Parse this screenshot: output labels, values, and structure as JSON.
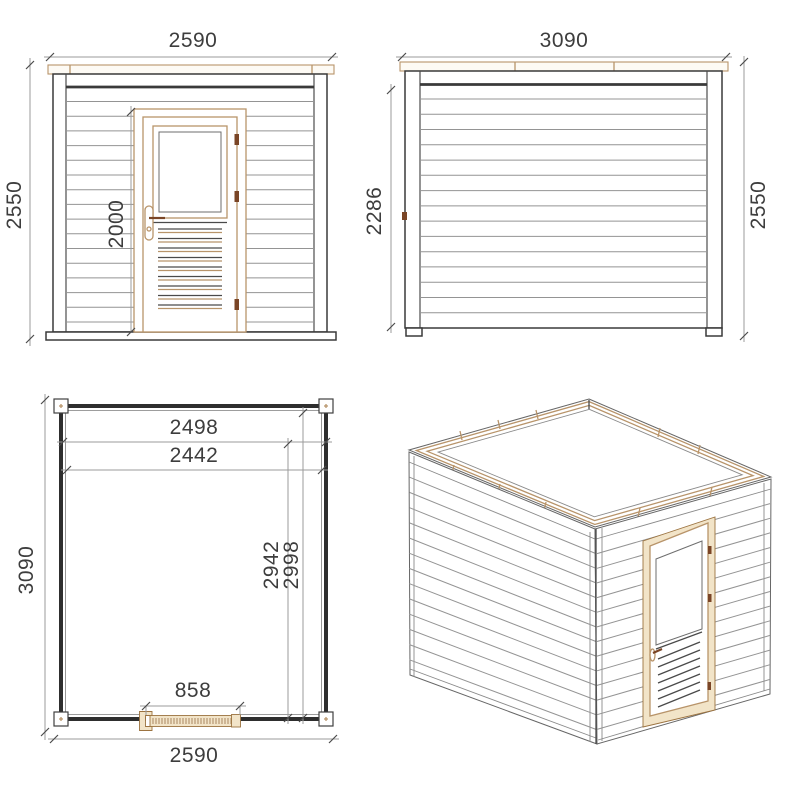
{
  "colors": {
    "background": "#ffffff",
    "outline_dark": "#3a3a3a",
    "siding_gray": "#949494",
    "dimension_line": "#9b9b9b",
    "dimension_text": "#3d3d3d",
    "wood_accent": "#b8946a",
    "wood_fill": "#f2e4c8",
    "hinge_brown": "#7a4526"
  },
  "views": {
    "front_elevation": {
      "dims": {
        "overall_width": "2590",
        "overall_height": "2550",
        "door_height": "2000"
      }
    },
    "side_elevation": {
      "dims": {
        "overall_width": "3090",
        "overall_height": "2550",
        "wall_height": "2286"
      }
    },
    "floor_plan": {
      "dims": {
        "inner_width": "2498",
        "inner_width_2": "2442",
        "overall_depth": "3090",
        "inner_depth": "2942",
        "inner_depth_2": "2998",
        "door_opening": "858",
        "overall_width": "2590"
      }
    }
  }
}
